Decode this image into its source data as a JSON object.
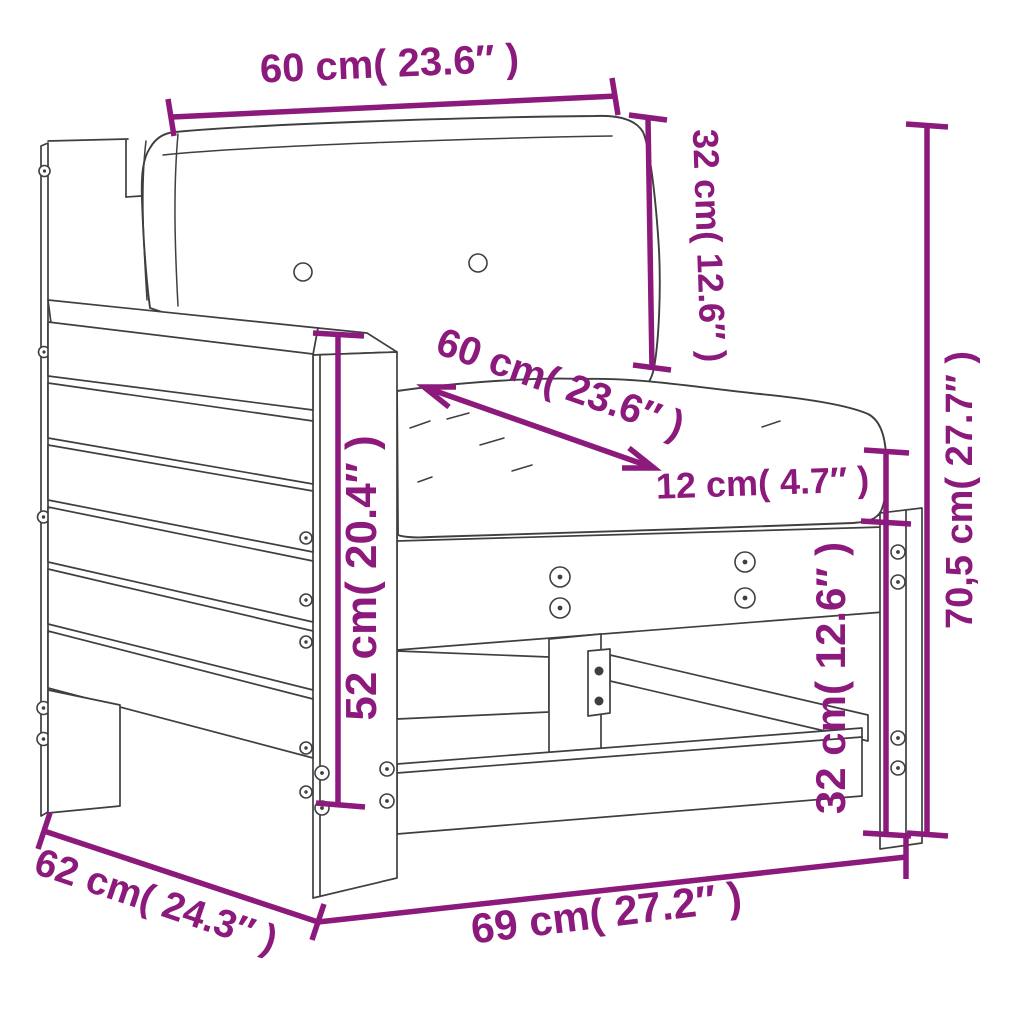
{
  "diagram": {
    "type": "furniture-dimension-diagram",
    "subject": "garden sofa section with left armrest and two cushions",
    "accent_color": "#8C1A7C",
    "outline_color": "#3F3F3F",
    "background_color": "#FFFFFF",
    "dimensions": [
      {
        "id": "back-cushion-width",
        "label": "60 cm( 23.6″ )",
        "cm": "60",
        "inches": "23.6",
        "placement": "top"
      },
      {
        "id": "back-cushion-height",
        "label": "32 cm( 12.6″ )",
        "cm": "32",
        "inches": "12.6",
        "placement": "top-right"
      },
      {
        "id": "seat-cushion-width",
        "label": "60 cm( 23.6″ )",
        "cm": "60",
        "inches": "23.6",
        "placement": "seat-diagonal"
      },
      {
        "id": "seat-cushion-thickness",
        "label": "12 cm( 4.7″ )",
        "cm": "12",
        "inches": "4.7",
        "placement": "right-of-seat"
      },
      {
        "id": "seat-frame-height",
        "label": "32 cm( 12.6″ )",
        "cm": "32",
        "inches": "12.6",
        "placement": "right-lower"
      },
      {
        "id": "overall-height",
        "label": "70,5 cm( 27.7″ )",
        "cm": "70,5",
        "inches": "27.7",
        "placement": "far-right"
      },
      {
        "id": "armrest-height",
        "label": "52 cm( 20.4″ )",
        "cm": "52",
        "inches": "20.4",
        "placement": "armrest-front"
      },
      {
        "id": "overall-depth",
        "label": "62 cm( 24.3″ )",
        "cm": "62",
        "inches": "24.3",
        "placement": "bottom-left-diagonal"
      },
      {
        "id": "overall-width",
        "label": "69 cm( 27.2″ )",
        "cm": "69",
        "inches": "27.2",
        "placement": "bottom"
      }
    ]
  }
}
